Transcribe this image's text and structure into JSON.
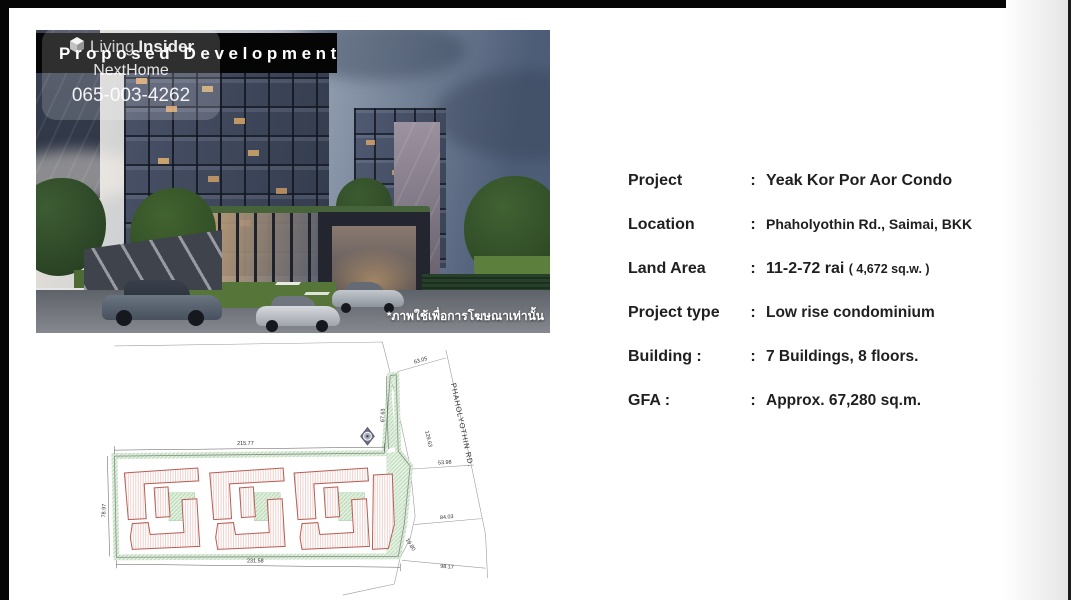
{
  "slide": {
    "title": "Proposed Development",
    "watermark": {
      "brand_light": "Living",
      "brand_bold": "Insider",
      "line2": "NextHome",
      "phone": "065-003-4262"
    },
    "photo_caption_thai": "*ภาพใช้เพื่อการโฆษณาเท่านั้น"
  },
  "details": {
    "colon": ":",
    "rows": [
      {
        "label": "Project",
        "value": "Yeak Kor Por Aor Condo"
      },
      {
        "label": "Location",
        "value": "Phaholyothin Rd., Saimai, BKK"
      },
      {
        "label": "Land Area",
        "value": "11-2-72 rai",
        "value_small": "( 4,672 sq.w. )"
      },
      {
        "label": "Project type",
        "value": "Low rise condominium"
      },
      {
        "label": "Building :",
        "value": "7 Buildings, 8 floors."
      },
      {
        "label": "GFA :",
        "value": "Approx. 67,280 sq.m."
      }
    ]
  },
  "site_plan": {
    "road_label": "PHAHOLYOTHIN RD.",
    "dims": {
      "top": "215.77",
      "bottom": "231.58",
      "left": "78.97",
      "inner_right": "67.63",
      "frontage_top": "63.05",
      "road_edge": "129.63",
      "frontage_mid": "53.98",
      "frontage_lower": "84.03",
      "corner": "19.80",
      "frontage_bottom": "98.17"
    }
  },
  "colors": {
    "title_bar": "#050505",
    "building_outline": "#b85c54",
    "site_green": "#cfe6cc",
    "sky_dusk": "#4e5d77"
  }
}
